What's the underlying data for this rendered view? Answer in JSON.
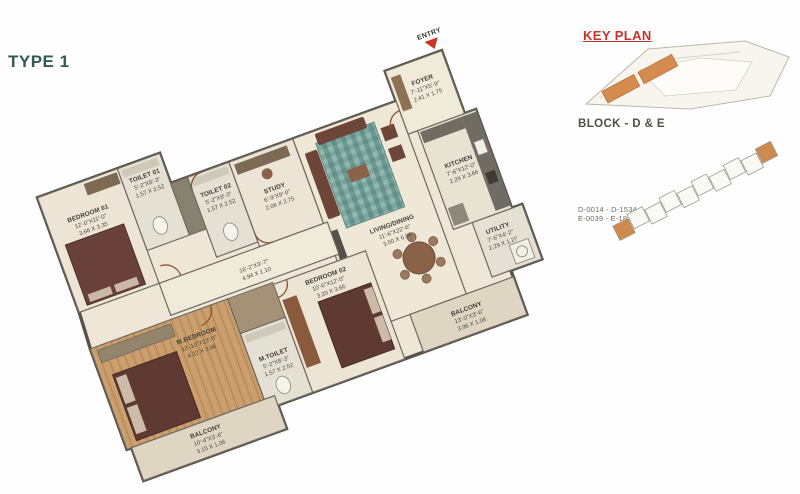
{
  "type_label": "TYPE 1",
  "key_plan": {
    "title": "KEY PLAN",
    "block_label": "BLOCK - D & E",
    "unit_range_d": "D-0014 - D-1534",
    "unit_range_e": "E-0039 - E-1839"
  },
  "floor_plan": {
    "entry_label": "ENTRY",
    "rooms": [
      {
        "name": "FOYER",
        "dim_ft": "7'-11\"X5'-9\"",
        "dim_m": "2.41 X 1.75"
      },
      {
        "name": "LIVING/DINING",
        "dim_ft": "11'-6\"X22'-6\"",
        "dim_m": "3.50 X 6.86"
      },
      {
        "name": "KITCHEN",
        "dim_ft": "7'-6\"X12'-0\"",
        "dim_m": "2.29 X 3.66"
      },
      {
        "name": "UTILITY",
        "dim_ft": "7'-6\"X4'-2\"",
        "dim_m": "2.29 X 1.27"
      },
      {
        "name": "BALCONY",
        "dim_ft": "13'-0\"X3'-6\"",
        "dim_m": "3.96 X 1.06"
      },
      {
        "name": "BEDROOM 01",
        "dim_ft": "12'-0\"X11'-0\"",
        "dim_m": "3.66 X 3.35"
      },
      {
        "name": "TOILET 01",
        "dim_ft": "5'-2\"X8'-3\"",
        "dim_m": "1.57 X 2.52"
      },
      {
        "name": "TOILET 02",
        "dim_ft": "5'-2\"X8'-3\"",
        "dim_m": "1.57 X 2.52"
      },
      {
        "name": "STUDY",
        "dim_ft": "6'-9\"X9'-0\"",
        "dim_m": "2.06 X 2.75"
      },
      {
        "name": "",
        "dim_ft": "16'-2\"X3'-7\"",
        "dim_m": "4.94 X 1.10"
      },
      {
        "name": "BEDROOM 02",
        "dim_ft": "10'-6\"X12'-0\"",
        "dim_m": "3.20 X 3.66"
      },
      {
        "name": "M.TOILET",
        "dim_ft": "5'-2\"X8'-3\"",
        "dim_m": "1.57 X 2.52"
      },
      {
        "name": "M.BEDROOM",
        "dim_ft": "13'-10\"X13'-0\"",
        "dim_m": "4.22 X 3.96"
      },
      {
        "name": "BALCONY",
        "dim_ft": "10'-4\"X3'-6\"",
        "dim_m": "3.15 X 1.06"
      }
    ]
  },
  "colors": {
    "title_teal": "#315a50",
    "key_plan_red": "#c2342a",
    "entry_arrow_red": "#cf3227",
    "wall": "#5b554c",
    "floor_cream": "#eee7d8",
    "wood_floor": "#c89d6b",
    "rug_teal": "#7ba7a0",
    "bed_brown": "#5f3a33",
    "highlight_orange": "#d68c4e"
  }
}
